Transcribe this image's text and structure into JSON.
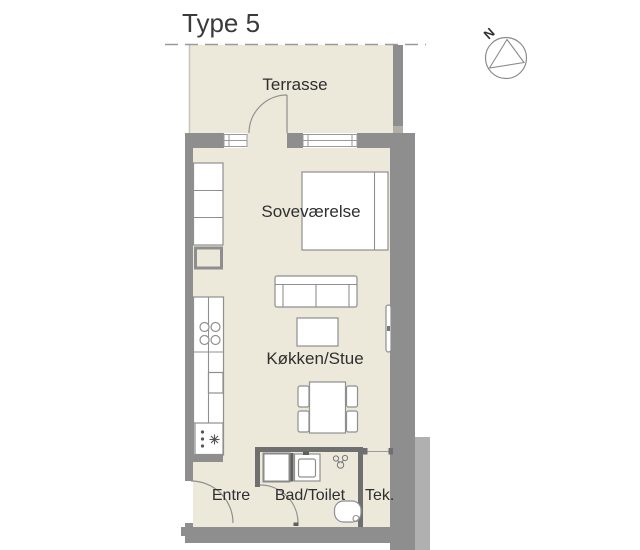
{
  "title": "Type 5",
  "compass": {
    "label": "N"
  },
  "rooms": {
    "terrace": {
      "label": "Terrasse"
    },
    "bedroom": {
      "label": "Soveværelse"
    },
    "kitchen_living": {
      "label": "Køkken/Stue"
    },
    "entry": {
      "label": "Entre"
    },
    "bathroom": {
      "label": "Bad/Toilet"
    },
    "tech": {
      "label": "Tek."
    }
  },
  "colors": {
    "floor": "#ECE8DA",
    "exterior_wall": "#8E8E8E",
    "interior_wall": "#6F6F6F",
    "wall_joint_light": "#B3AFA7",
    "furniture_outline": "#8F8F8F",
    "text": "#2F2F2F",
    "boundary_dash": "#9A9A9A"
  }
}
